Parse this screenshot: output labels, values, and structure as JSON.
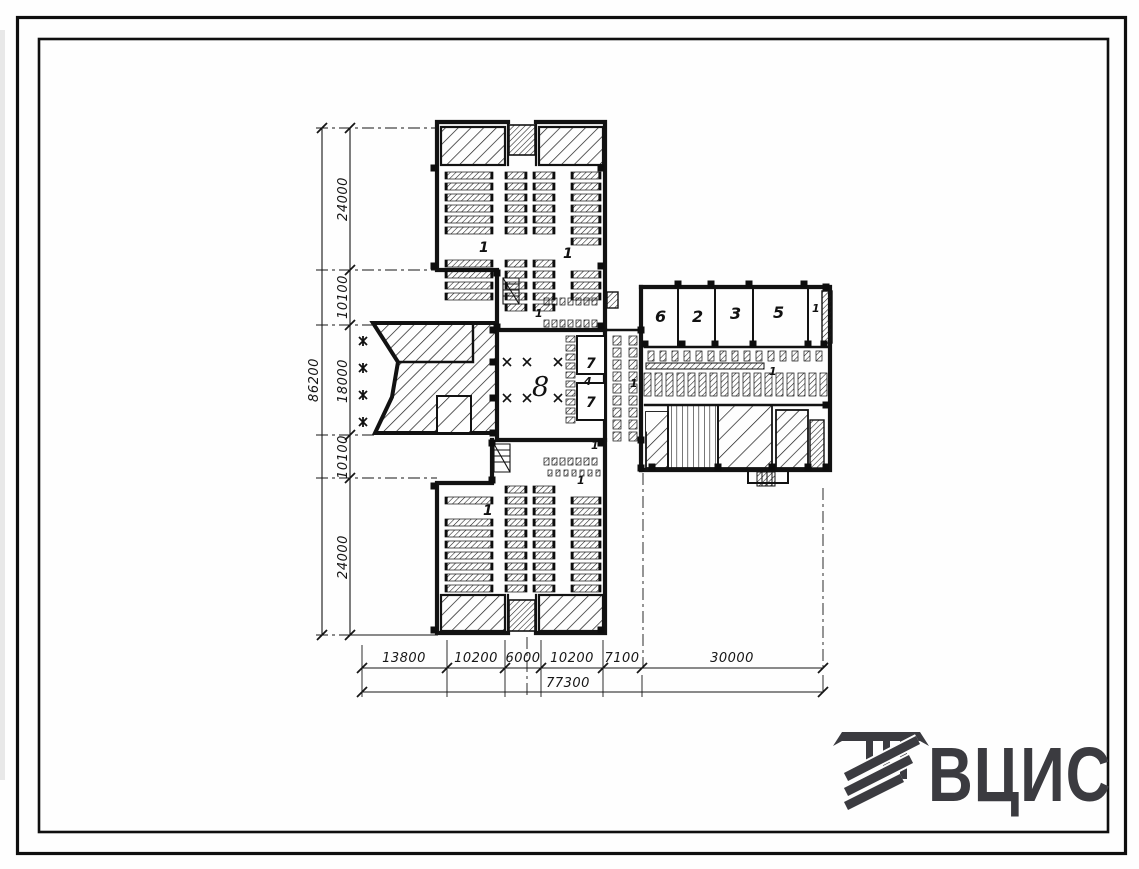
{
  "rooms": [
    {
      "label": "1"
    },
    {
      "label": "1"
    },
    {
      "label": "1"
    },
    {
      "label": "1"
    },
    {
      "label": "6"
    },
    {
      "label": "2"
    },
    {
      "label": "3"
    },
    {
      "label": "5"
    },
    {
      "label": "7"
    },
    {
      "label": "4"
    },
    {
      "label": "7"
    },
    {
      "label": "8"
    },
    {
      "label": "1"
    },
    {
      "label": "1"
    },
    {
      "label": "1"
    },
    {
      "label": "1"
    },
    {
      "label": "1"
    }
  ],
  "dims": {
    "left": {
      "overall": "86200",
      "segments": [
        "24000",
        "10100",
        "18000",
        "10100",
        "24000"
      ]
    },
    "bottom": {
      "overall": "77300",
      "segments": [
        "13800",
        "10200",
        "6000",
        "10200",
        "7100",
        "30000"
      ]
    }
  },
  "logo": {
    "text": "ВЦИС",
    "icon": "column-with-stripes"
  },
  "colors": {
    "ink": "#141414",
    "logo": "#3b3b40",
    "paper": "#fefefe"
  }
}
